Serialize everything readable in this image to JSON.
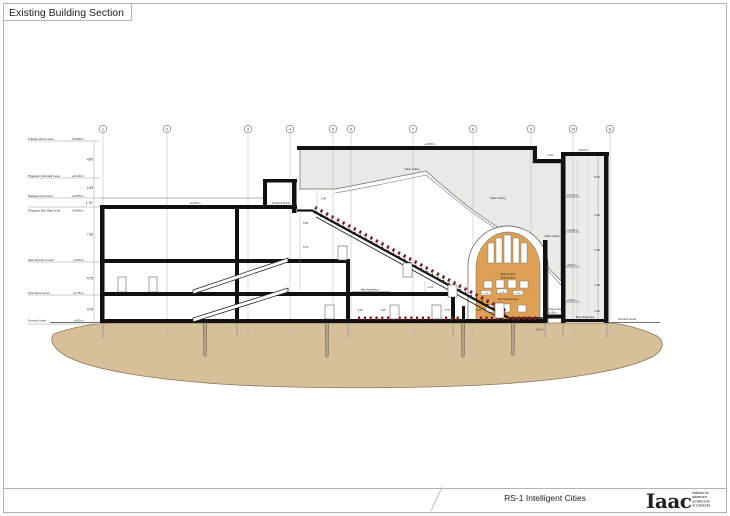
{
  "sheet": {
    "title": "Existing Building Section",
    "project": "RS-1 Intelligent Cities",
    "logo": "Iaac",
    "logo_tagline_1": "Institute for",
    "logo_tagline_2": "advanced",
    "logo_tagline_3": "architecture",
    "logo_tagline_4": "of Catalonia"
  },
  "grid_labels": [
    "1",
    "2",
    "3",
    "4",
    "5",
    "6",
    "7",
    "8",
    "9",
    "10",
    "11"
  ],
  "levels": {
    "l1": {
      "name": "Theatre Roof Level",
      "elev": "+25.80 m"
    },
    "l2": {
      "name": "Projector Unit Half Level",
      "elev": "+21.00 m"
    },
    "l3": {
      "name": "Parapet Unit Level",
      "elev": "+18.55 m"
    },
    "l4": {
      "name": "Projector Box Half Level",
      "elev": "+16.80 m"
    },
    "l5": {
      "name": "Second Floor Level",
      "elev": "+9.50 m"
    },
    "l6": {
      "name": "First Floor Level",
      "elev": "+4.75 m"
    },
    "l7": {
      "name": "Ground Level",
      "elev": "+0.00 m"
    }
  },
  "dims": {
    "left_1": "4.80",
    "left_2": "2.45",
    "left_3": "1.75",
    "left_4": "7.30",
    "left_5": "4.75",
    "left_6": "4.75",
    "stair_1": "2.40",
    "stair_2": "3.50",
    "stair_3": "3.79",
    "stair_4": "1.34",
    "roof_step": "2.20",
    "row_1": "4.45",
    "row_2": "4.35",
    "row_3": "4.75",
    "row_4": "4.45",
    "tower_1": "5.00",
    "tower_2": "4.25",
    "tower_3": "4.25",
    "tower_4": "4.25",
    "tower_5": "4.40"
  },
  "tower": {
    "top_elev": "+22.15 m",
    "tick_1": "+17.15 m",
    "tick_2": "+12.90 m",
    "tick_3": "+8.65 m",
    "tick_4": "+4.40 m",
    "area_label": "Back Stage Area"
  },
  "labels": {
    "false_ceiling_1": "False Ceiling",
    "false_ceiling_2": "False Ceiling",
    "false_ceiling_3": "False Ceiling",
    "roof_elev": "+25.80 m",
    "slab_elev": "+16.80 m",
    "projector_room": "Projector Room",
    "main_auditorium": "Main Auditorium",
    "performance_stage": "Performance Stage",
    "performance_stage_elev": "+0.60 m",
    "pit_elev": "-0.75 m",
    "ground_left": "Ground Level",
    "ground_right": "Ground Level",
    "balcony_line1": "Balcony Box",
    "balcony_line2": "Seating Area",
    "box_seating": "Box Seating Area",
    "tag_1": "+1.20",
    "tag_2": "+2.40",
    "tag_3": "+1.20"
  },
  "colors": {
    "ground": "#d7bf99",
    "roof_fill": "#e9e9e6",
    "stage_fill": "#dda055",
    "seats": "#7a1c1c"
  }
}
